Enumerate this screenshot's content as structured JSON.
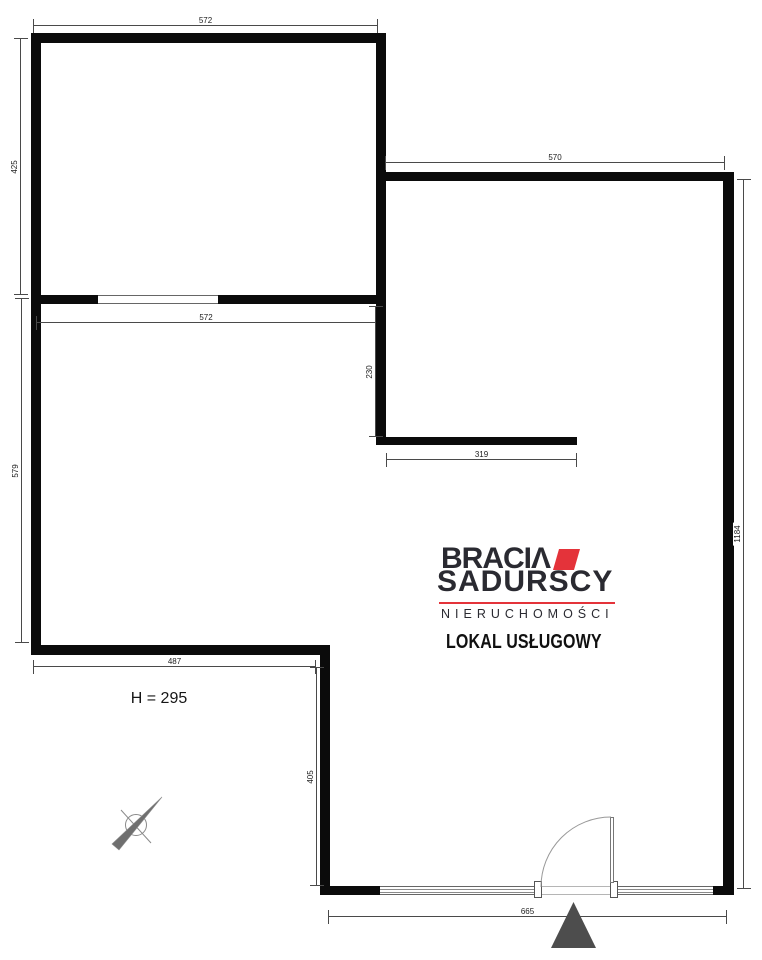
{
  "plan": {
    "property_type": "LOKAL USŁUGOWY",
    "ceiling_height": "H = 295"
  },
  "branding": {
    "name_line1": "BRACIΛ",
    "name_line2": "SADURSCY",
    "tagline": "NIERUCHOMOŚCI"
  },
  "dimensions": {
    "top_room_width": "572",
    "top_room_height": "425",
    "right_room_width": "570",
    "right_side_total_height": "1184",
    "interior_wall_width": "572",
    "passage_depth": "230",
    "interior_lower_wall_width": "319",
    "left_room_height": "579",
    "left_room_bottom_width": "487",
    "lower_section_height": "405",
    "bottom_front_width": "665"
  },
  "colors": {
    "background": "#ffffff",
    "wall": "#0b0b0b",
    "dim_line": "#4a4a4a",
    "dim_text": "#1c1c1c",
    "brand_dark": "#2a2a31",
    "brand_red": "#e4333a",
    "entrance_marker": "#4d4d4d"
  }
}
